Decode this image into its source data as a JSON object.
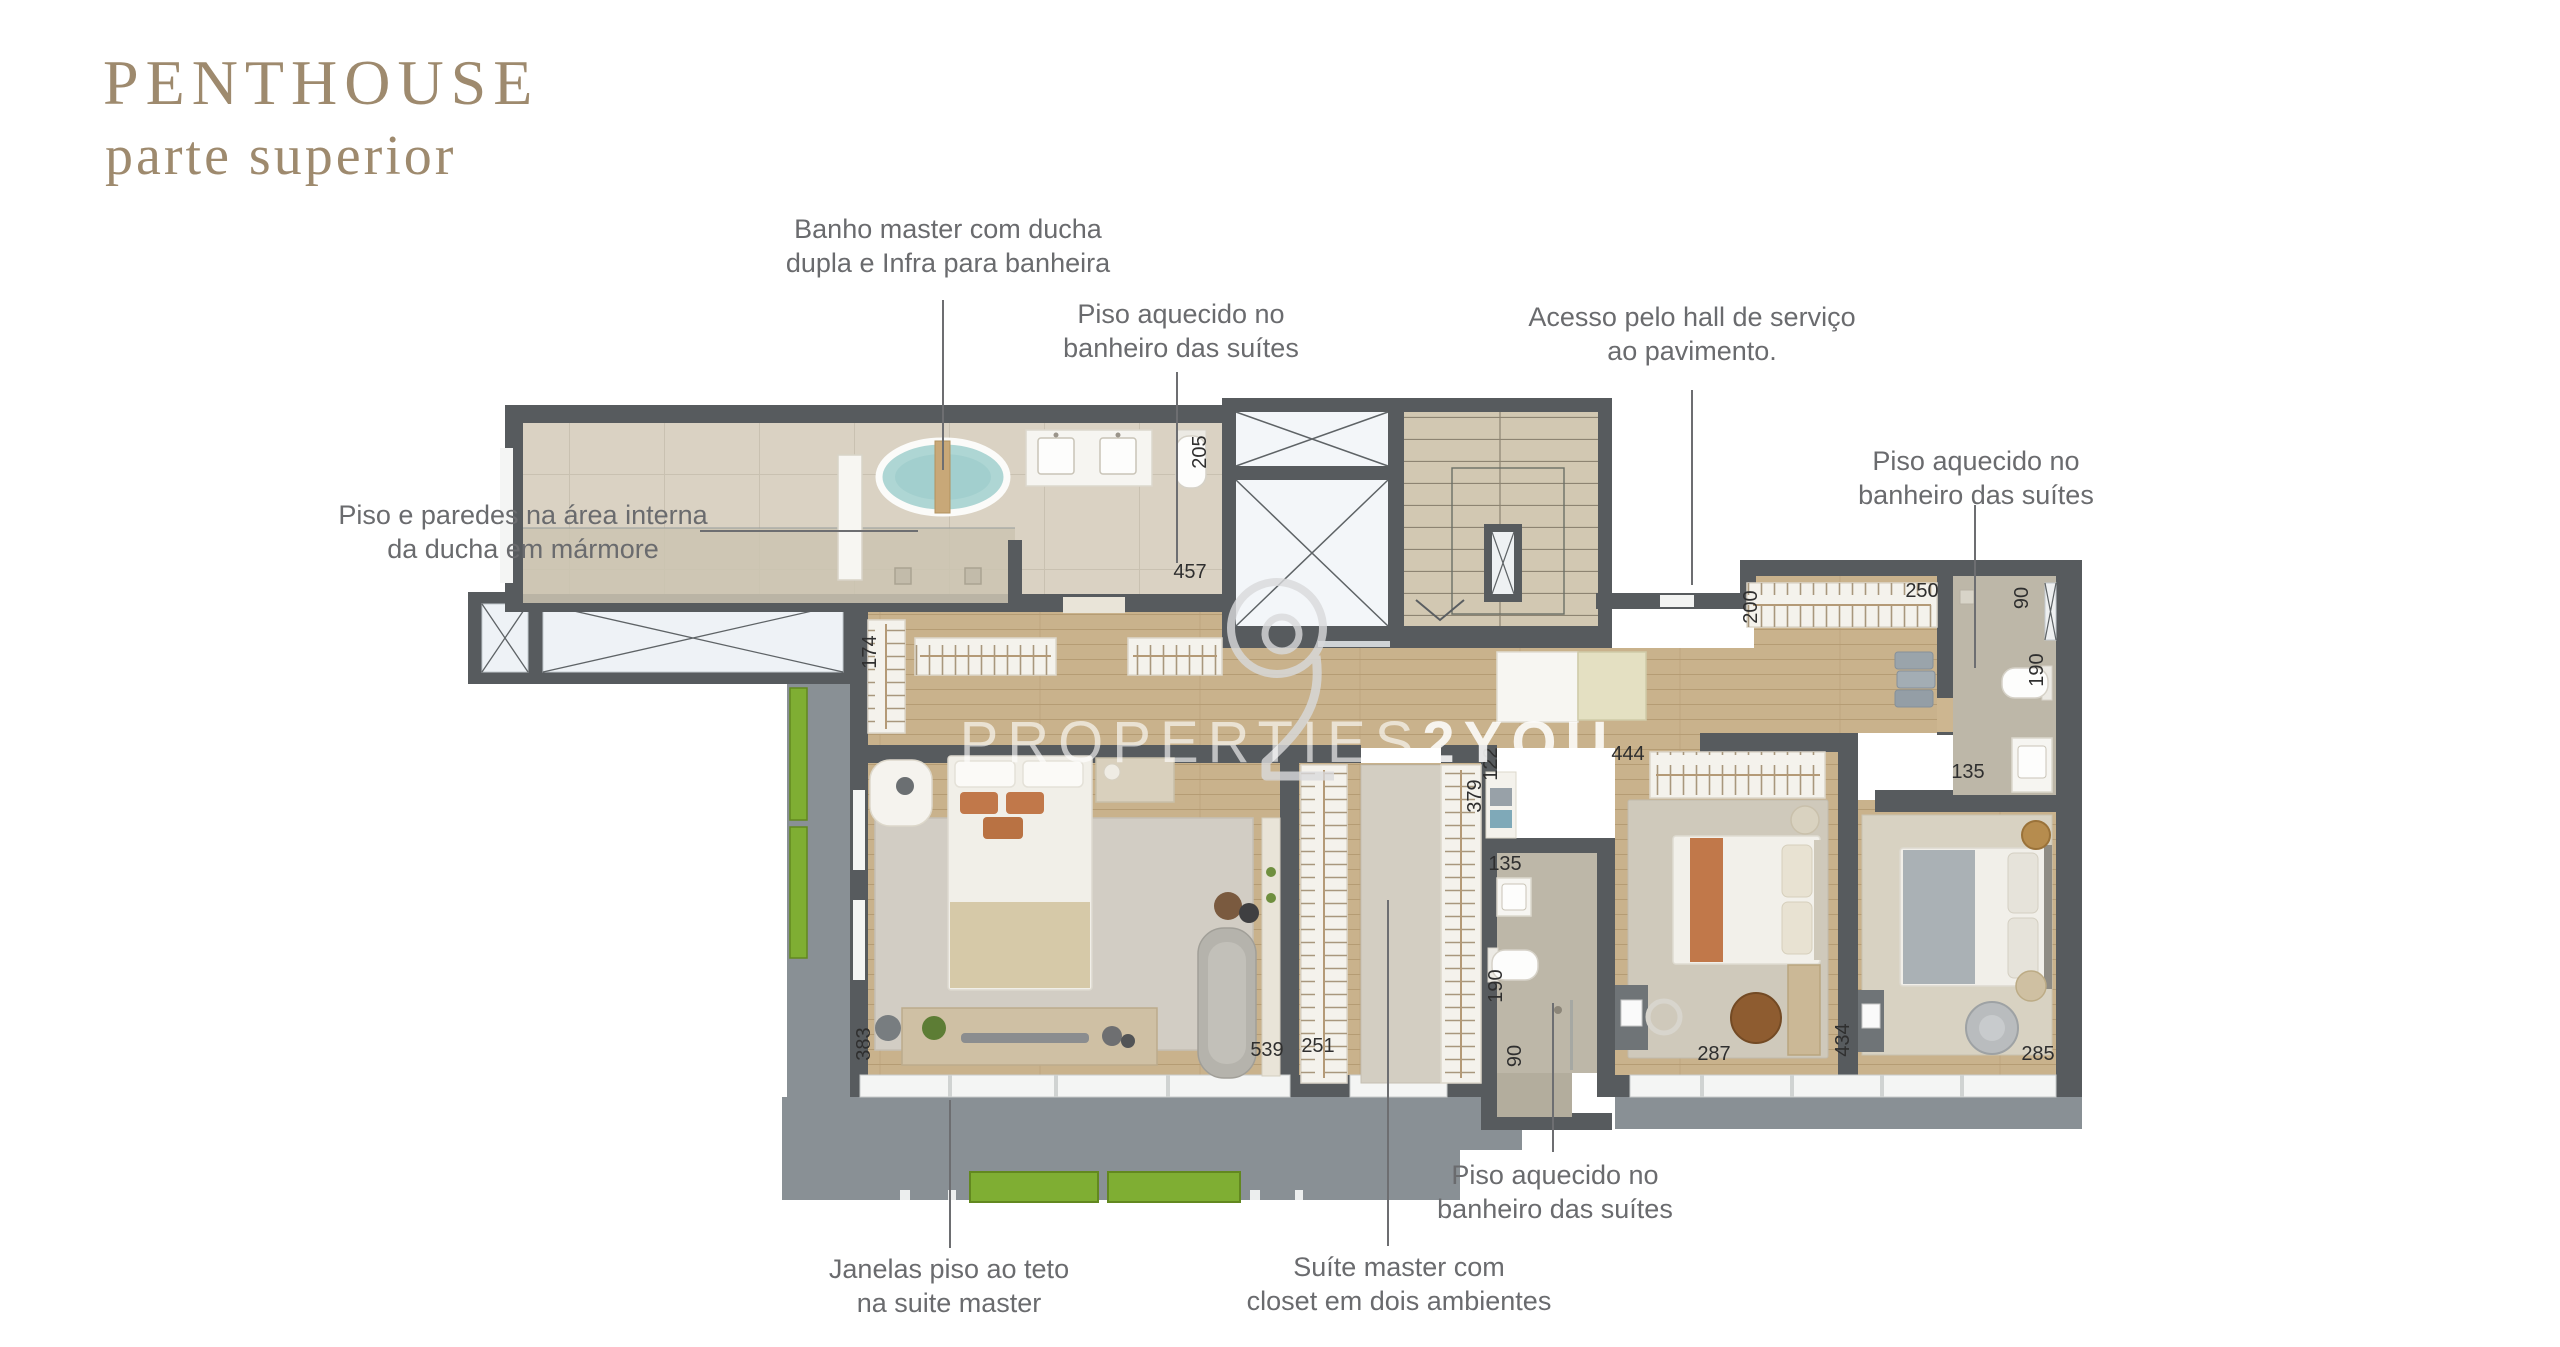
{
  "header": {
    "title": "PENTHOUSE",
    "subtitle": "parte superior"
  },
  "watermark": {
    "text_thin": "PROPERTIES",
    "text_bold": "2YOU",
    "logo": "2-circle-logo"
  },
  "annotations": {
    "banho_master": {
      "line1": "Banho master com ducha",
      "line2": "dupla e Infra para banheira"
    },
    "piso_suites_top": {
      "line1": "Piso aquecido no",
      "line2": "banheiro das suítes"
    },
    "acesso_hall": {
      "line1": "Acesso pelo hall de serviço",
      "line2": "ao pavimento."
    },
    "piso_suites_right": {
      "line1": "Piso aquecido no",
      "line2": "banheiro das suítes"
    },
    "piso_paredes_marmore": {
      "line1": "Piso e paredes na área interna",
      "line2": "da ducha em mármore"
    },
    "piso_suites_bottom": {
      "line1": "Piso aquecido no",
      "line2": "banheiro das suítes"
    },
    "janelas": {
      "line1": "Janelas piso ao teto",
      "line2": "na suite master"
    },
    "suite_master": {
      "line1": "Suíte master com",
      "line2": "closet em dois ambientes"
    }
  },
  "plan": {
    "colors": {
      "wall": "#575b5e",
      "wood": "#c9b28c",
      "tile": "#dad2c3",
      "marble": "#bdb7a8",
      "stone": "#d2c8b2",
      "slab": "#899095",
      "planter": "#7fae33",
      "water": "#aed6d4",
      "title_accent": "#9e8a6e",
      "label_gray": "#6a6b6e",
      "rack_white": "#f4f2ec"
    },
    "dimensions": [
      {
        "v": "205",
        "x": 1206,
        "y": 452,
        "r": -90
      },
      {
        "v": "457",
        "x": 1190,
        "y": 578,
        "r": 0
      },
      {
        "v": "174",
        "x": 876,
        "y": 652,
        "r": -90
      },
      {
        "v": "200",
        "x": 1757,
        "y": 607,
        "r": -90
      },
      {
        "v": "250",
        "x": 1922,
        "y": 597,
        "r": 0
      },
      {
        "v": "90",
        "x": 2028,
        "y": 598,
        "r": -90
      },
      {
        "v": "190",
        "x": 2043,
        "y": 670,
        "r": -90
      },
      {
        "v": "135",
        "x": 1968,
        "y": 778,
        "r": 0
      },
      {
        "v": "444",
        "x": 1628,
        "y": 760,
        "r": 0
      },
      {
        "v": "379",
        "x": 1481,
        "y": 796,
        "r": -90
      },
      {
        "v": "122",
        "x": 1497,
        "y": 764,
        "r": -90
      },
      {
        "v": "135",
        "x": 1505,
        "y": 870,
        "r": 0
      },
      {
        "v": "190",
        "x": 1502,
        "y": 986,
        "r": -90
      },
      {
        "v": "90",
        "x": 1521,
        "y": 1056,
        "r": -90
      },
      {
        "v": "287",
        "x": 1714,
        "y": 1060,
        "r": 0
      },
      {
        "v": "434",
        "x": 1849,
        "y": 1040,
        "r": -90
      },
      {
        "v": "285",
        "x": 2038,
        "y": 1060,
        "r": 0
      },
      {
        "v": "383",
        "x": 870,
        "y": 1044,
        "r": -90
      },
      {
        "v": "539",
        "x": 1267,
        "y": 1056,
        "r": 0
      },
      {
        "v": "251",
        "x": 1318,
        "y": 1052,
        "r": 0
      }
    ]
  }
}
